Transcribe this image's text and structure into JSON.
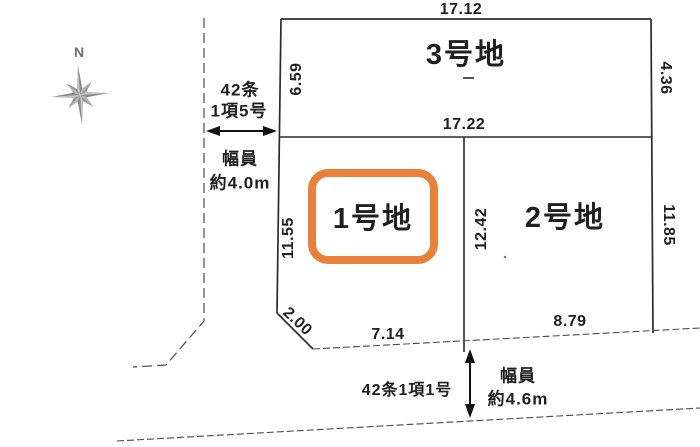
{
  "diagram_title": "land-plot-layout",
  "compass": {
    "label": "N"
  },
  "roads": {
    "left": {
      "class_line1": "42条",
      "class_line2": "1項5号",
      "width_label": "幅員",
      "width_value": "約4.0m"
    },
    "bottom": {
      "classification": "42条1項1号",
      "width_label": "幅員",
      "width_value": "約4.6m"
    }
  },
  "plots": {
    "plot1": {
      "name": "1号地",
      "left": "11.55",
      "bottom": "7.14",
      "corner_cut": "2.00",
      "highlighted": true
    },
    "plot2": {
      "name": "2号地",
      "left": "12.42",
      "right": "11.85",
      "bottom": "8.79",
      "highlighted": false
    },
    "plot3": {
      "name": "3号地",
      "top": "17.12",
      "left": "6.59",
      "right": "4.36",
      "bottom": "17.22",
      "highlighted": false
    }
  },
  "colors": {
    "highlight": "#e8823b",
    "outline": "#2b2b2b",
    "road_line": "#4a4a4a",
    "compass_dark": "#8a8a8a",
    "compass_light": "#c2c2c2",
    "text": "#1f1f1f"
  }
}
